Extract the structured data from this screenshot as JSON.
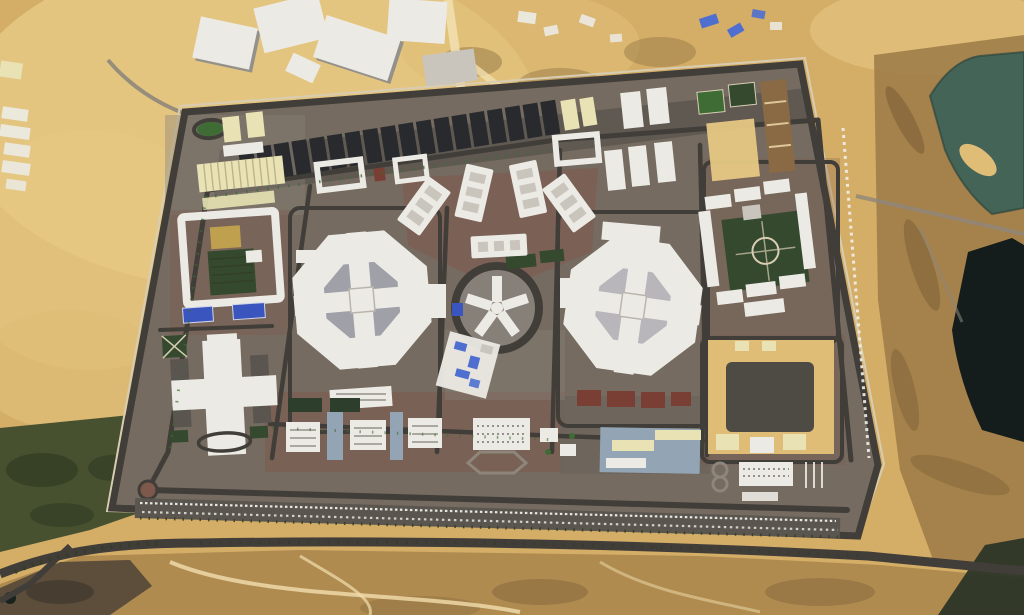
{
  "scene": {
    "type": "satellite-aerial-photo",
    "label": "Aerial satellite view of a large walled desert compound with two octagonal cell-block buildings, a central circular hub, warehouse rows, courtyards and a perimeter road, surrounded by desert, lakes and a construction site",
    "zoom_text": "",
    "visible_text": []
  },
  "features": [
    "desert-terrain",
    "construction-site-north",
    "left-edge-buildings",
    "scrubland-west",
    "highway-south",
    "lakes-east",
    "walled-compound",
    "perimeter-road",
    "warehouse-row",
    "workshops-west",
    "nw-entrance-oval",
    "west-courtyard-compound",
    "sports-courts",
    "octagon-west",
    "central-ring-hub",
    "octagon-east",
    "fan-apartment-blocks",
    "north-small-compounds",
    "housing-east",
    "northeast-lawns",
    "red-roof-row",
    "inner-construction-cluster",
    "bottom-cluster",
    "parade-ground",
    "loop8-depot",
    "cross-complex-southwest",
    "roundabout-southwest",
    "parking-esplanade",
    "truck-line-east"
  ],
  "colors": {
    "sand_base": "#d4ad67",
    "sand_light": "#e6c883",
    "sand_pale": "#f2dfae",
    "sand_bright": "#dfbd77",
    "desert_south": "#b08b50",
    "desert_blotch": "#8a6c3e",
    "terrain_right": "#9c7a46",
    "terrain_rugged": "#7a5c36",
    "rock_dark": "#56493a",
    "scrub_green": "#47512f",
    "scrub_dark": "#333d24",
    "lake_teal": "#456458",
    "lake_black": "#141d1b",
    "water_corner": "#2c3527",
    "shore": "#2e463d",
    "road_asphalt": "#413d38",
    "road_light": "#8e867a",
    "ground_compound": "#756b60",
    "ground_gray": "#868079",
    "apron_dark": "#5f5952",
    "plaza_red": "#7f584c",
    "red_roof": "#793f34",
    "building_white": "#eceae4",
    "building_gray": "#c9c5bc",
    "shadow_gray": "#94908a",
    "building_cream": "#e8e2b4",
    "cream_rib": "#bdb489",
    "roof_dark": "#282a2e",
    "lawn": "#34492e",
    "lawn_bright": "#3f6b35",
    "court_blue": "#3b55bf",
    "tarp_blue": "#4f6fd0",
    "paved_blue": "#93a5b4",
    "gold_roof": "#bfa04e",
    "courtyard_gray": "#9fa0a8",
    "courtyard_gray2": "#b8b6ba",
    "fence_light": "#d8cdb2",
    "white_dash": "#f0efe9"
  }
}
